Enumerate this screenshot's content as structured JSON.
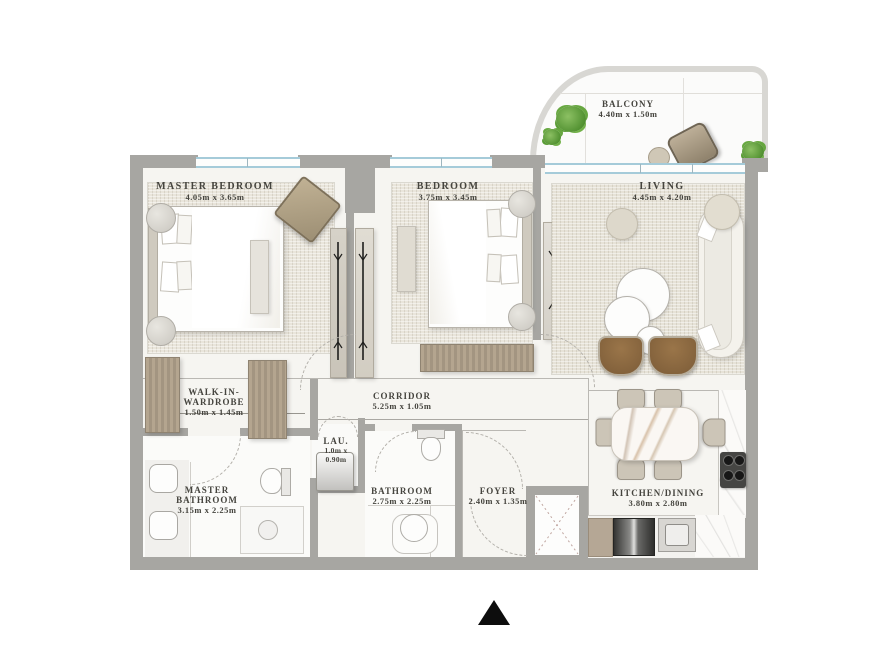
{
  "rooms": {
    "master_bedroom": {
      "name": "MASTER BEDROOM",
      "dims": "4.05m x 3.65m"
    },
    "bedroom": {
      "name": "BEDROOM",
      "dims": "3.75m x 3.45m"
    },
    "living": {
      "name": "LIVING",
      "dims": "4.45m x 4.20m"
    },
    "balcony": {
      "name": "BALCONY",
      "dims": "4.40m x 1.50m"
    },
    "walk_in_wardrobe": {
      "name_line1": "WALK-IN-",
      "name_line2": "WARDROBE",
      "dims": "1.50m x 1.45m"
    },
    "corridor": {
      "name": "CORRIDOR",
      "dims": "5.25m x 1.05m"
    },
    "laundry": {
      "name": "LAU.",
      "dims_line1": "1.0m x",
      "dims_line2": "0.90m"
    },
    "master_bathroom": {
      "name_line1": "MASTER",
      "name_line2": "BATHROOM",
      "dims": "3.15m x 2.25m"
    },
    "bathroom": {
      "name": "BATHROOM",
      "dims": "2.75m x 2.25m"
    },
    "foyer": {
      "name": "FOYER",
      "dims": "2.40m x 1.35m"
    },
    "kitchen_dining": {
      "name": "KITCHEN/DINING",
      "dims": "3.80m x 2.80m"
    }
  },
  "colors": {
    "wall": "#a7a6a2",
    "balcony_wall": "#d8d7d3",
    "floor": "#f6f5f1",
    "window_blue": "#a5cbd9",
    "text": "#45443e",
    "plant_green": "#5f9c3a",
    "wood": "#b2a28d",
    "chair_brown": "#8a6a45",
    "north_arrow": "#0d0d0d"
  }
}
